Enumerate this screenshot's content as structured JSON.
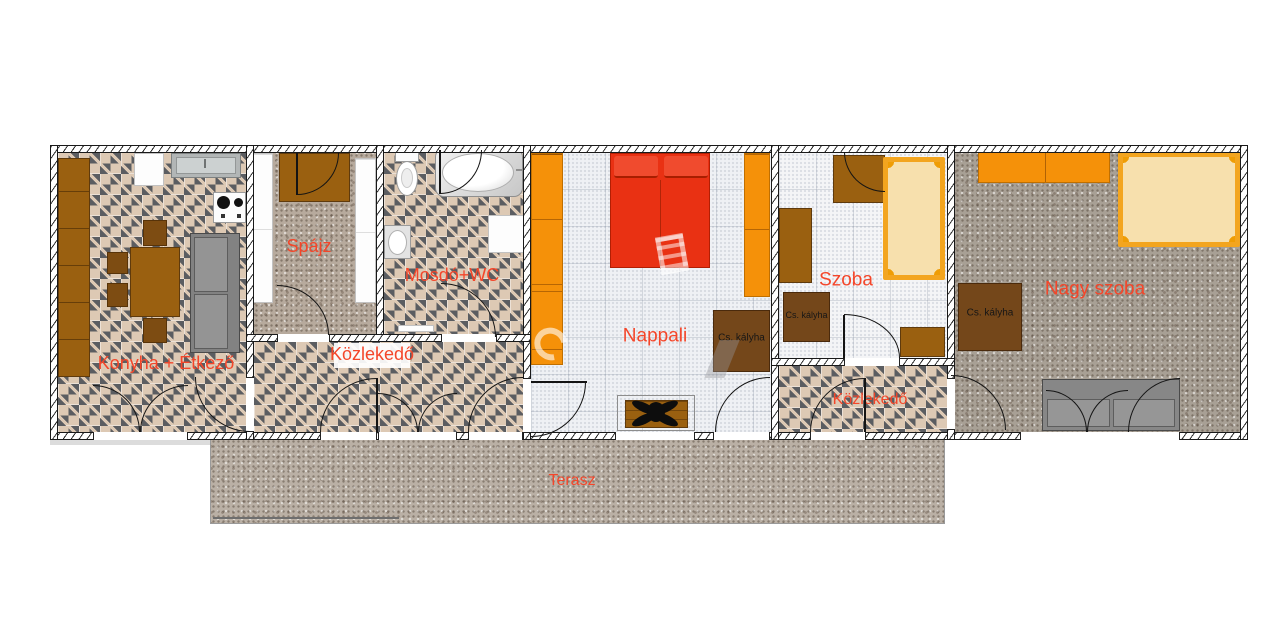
{
  "rooms": {
    "kitchen_dining": "Konyha + Étkező",
    "pantry": "Spájz",
    "bathroom": "Mosdó+WC",
    "hallway_1": "Közlekedő",
    "living_room": "Nappali",
    "room": "Szoba",
    "hallway_2": "Közlekedő",
    "large_room": "Nagy szoba",
    "terrace": "Terasz"
  },
  "stoves": {
    "living": "Cs. kályha",
    "room": "Cs. kályha",
    "large": "Cs. kályha"
  },
  "colors": {
    "room_label": "#f4462a",
    "stove_label": "#161616",
    "tile_floor": "#ddc9b4",
    "tile_diamond": "#5b5d61",
    "furniture_brown": "#9a6010",
    "stove_brown": "#74471a",
    "wardrobe_orange": "#f59109",
    "bed_red": "#e93113",
    "bed_frame_orange": "#f3a51f",
    "bed_fill_cream": "#f7e0ad",
    "sofa_gray": "#8e8e8e"
  }
}
